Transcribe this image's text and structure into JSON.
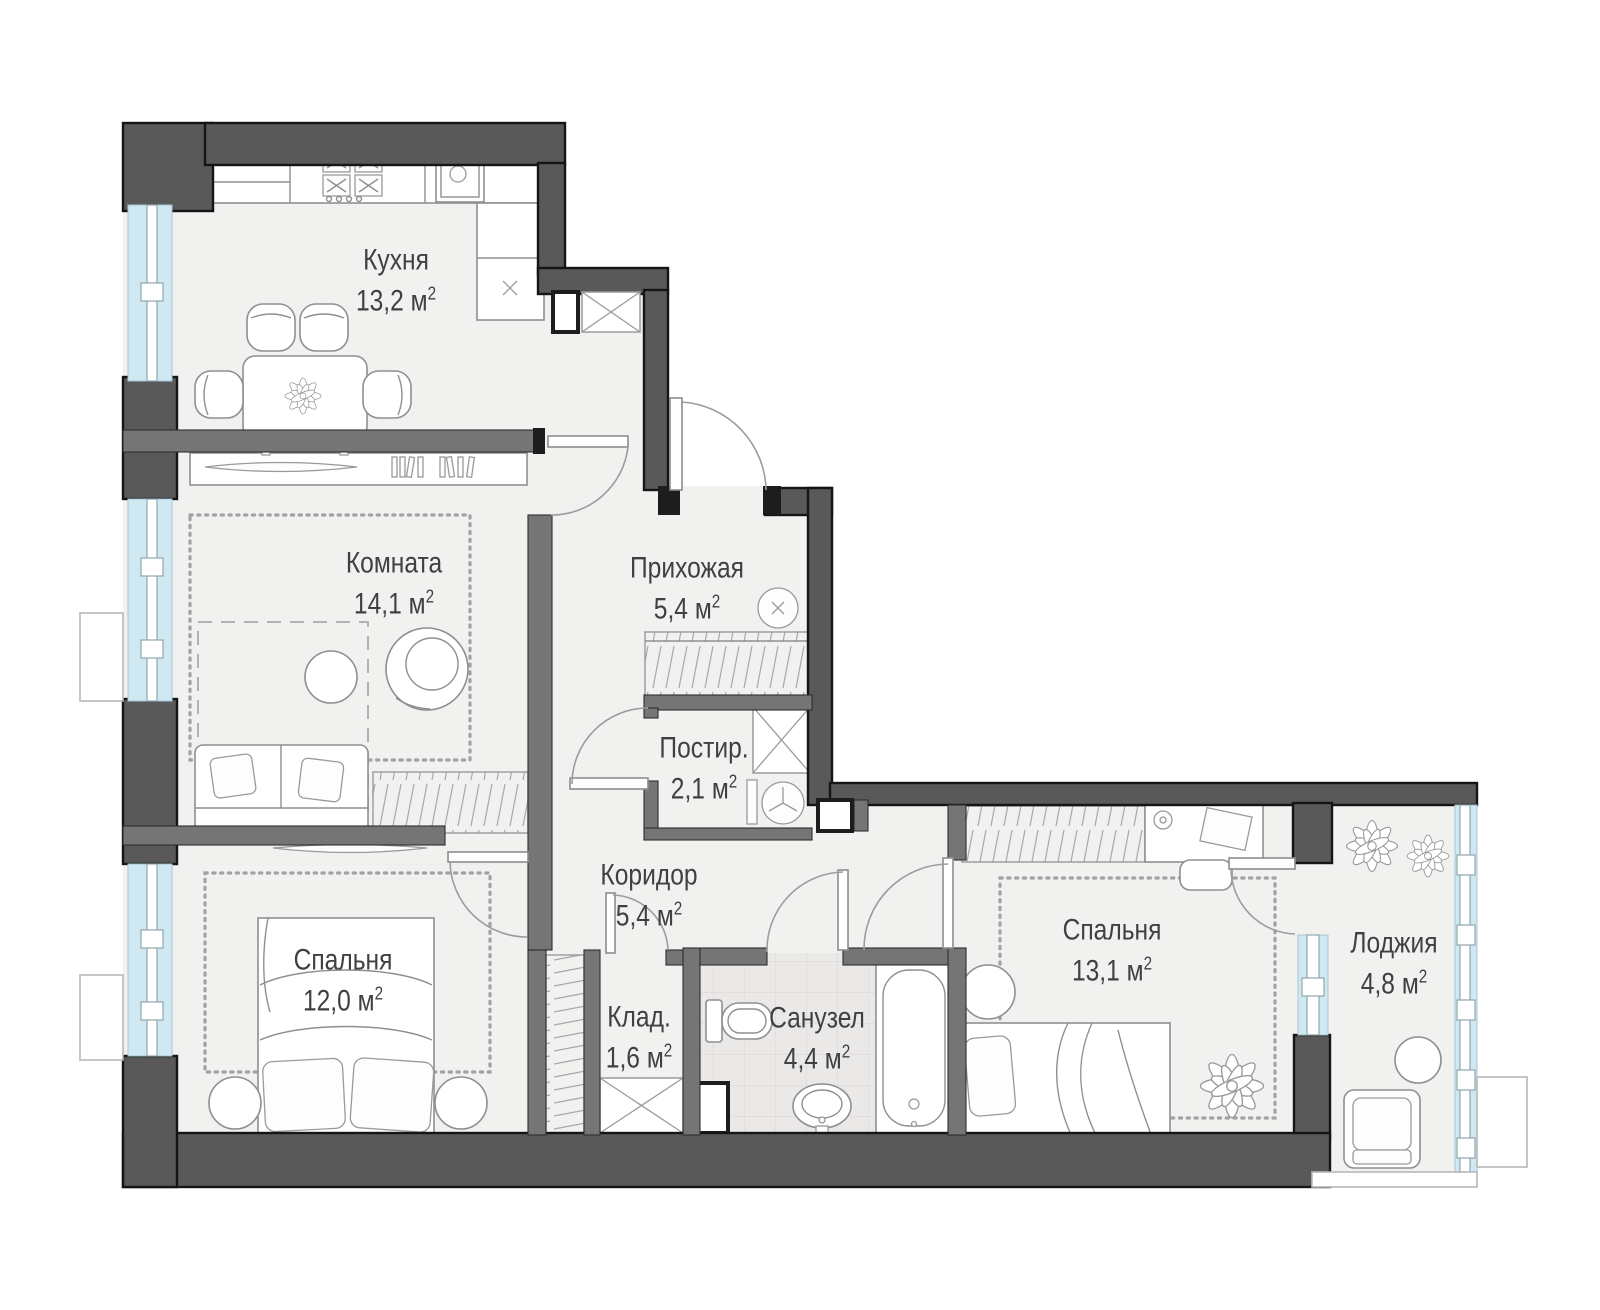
{
  "plan": {
    "type": "apartment-floor-plan",
    "language": "ru",
    "rooms": [
      {
        "id": "kitchen",
        "name": "Кухня",
        "area": "13,2 м",
        "sup": "2"
      },
      {
        "id": "room",
        "name": "Комната",
        "area": "14,1 м",
        "sup": "2"
      },
      {
        "id": "hallway",
        "name": "Прихожая",
        "area": "5,4 м",
        "sup": "2"
      },
      {
        "id": "laundry",
        "name": "Постир.",
        "area": "2,1 м",
        "sup": "2"
      },
      {
        "id": "corridor",
        "name": "Коридор",
        "area": "5,4 м",
        "sup": "2"
      },
      {
        "id": "bedroom-1",
        "name": "Спальня",
        "area": "12,0 м",
        "sup": "2"
      },
      {
        "id": "storage",
        "name": "Клад.",
        "area": "1,6 м",
        "sup": "2"
      },
      {
        "id": "bathroom",
        "name": "Санузел",
        "area": "4,4 м",
        "sup": "2"
      },
      {
        "id": "bedroom-2",
        "name": "Спальня",
        "area": "13,1 м",
        "sup": "2"
      },
      {
        "id": "loggia",
        "name": "Лоджия",
        "area": "4,8 м",
        "sup": "2"
      }
    ],
    "colors": {
      "wall": "#595959",
      "inner_wall": "#757575",
      "window_glass": "#cfe8f1",
      "floor": "#f1f1f0",
      "tile": "#ebe8e8",
      "line": "#8f8f8f",
      "text": "#404040",
      "outline": "#151515"
    }
  }
}
